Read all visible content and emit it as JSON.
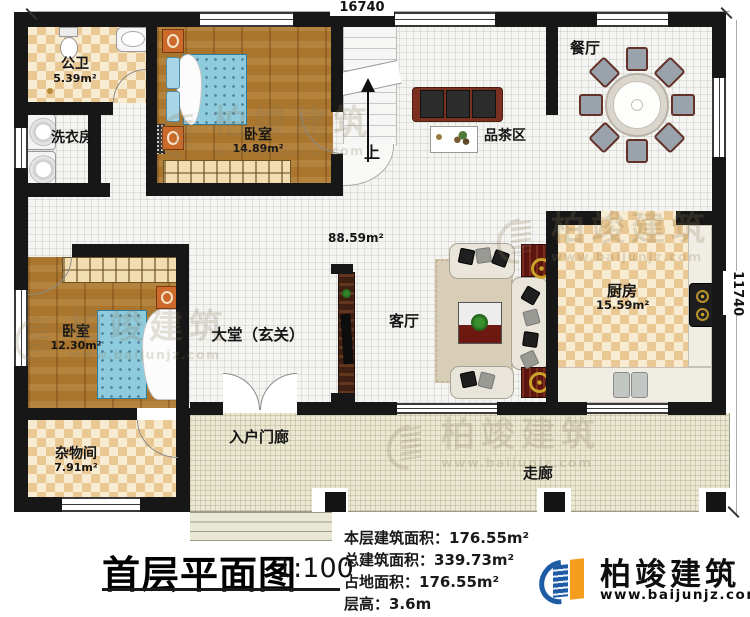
{
  "dimensions": {
    "width_label": "16740",
    "height_label": "11740"
  },
  "rooms": {
    "bath": {
      "name": "公卫",
      "area": "5.39m²"
    },
    "laundry": {
      "name": "洗衣房"
    },
    "bedroom_top": {
      "name": "卧室",
      "area": "14.89m²"
    },
    "bedroom_left": {
      "name": "卧室",
      "area": "12.30m²"
    },
    "dining": {
      "name": "餐厅"
    },
    "tea_area": {
      "name": "品茶区"
    },
    "stairs": {
      "up_label": "上"
    },
    "hall": {
      "name": "大堂（玄关）",
      "area": "88.59m²"
    },
    "living": {
      "name": "客厅"
    },
    "kitchen": {
      "name": "厨房",
      "area": "15.59m²"
    },
    "storage": {
      "name": "杂物间",
      "area": "7.91m²"
    },
    "entry_porch": {
      "name": "入户门廊"
    },
    "corridor": {
      "name": "走廊"
    }
  },
  "title_block": {
    "title": "首层平面图",
    "scale": "1:100",
    "stats": [
      "本层建筑面积：176.55m²",
      "总建筑面积：339.73m²",
      "占地面积：176.55m²",
      "层高：3.6m"
    ]
  },
  "branding": {
    "logo_text": "柏竣建筑",
    "logo_url": "www.baijunjz.com",
    "colors": {
      "blue": "#1d5ba4",
      "orange": "#f69c1e"
    }
  },
  "watermark": {
    "text": "柏竣建筑",
    "url": "www.baijunjz.com"
  }
}
